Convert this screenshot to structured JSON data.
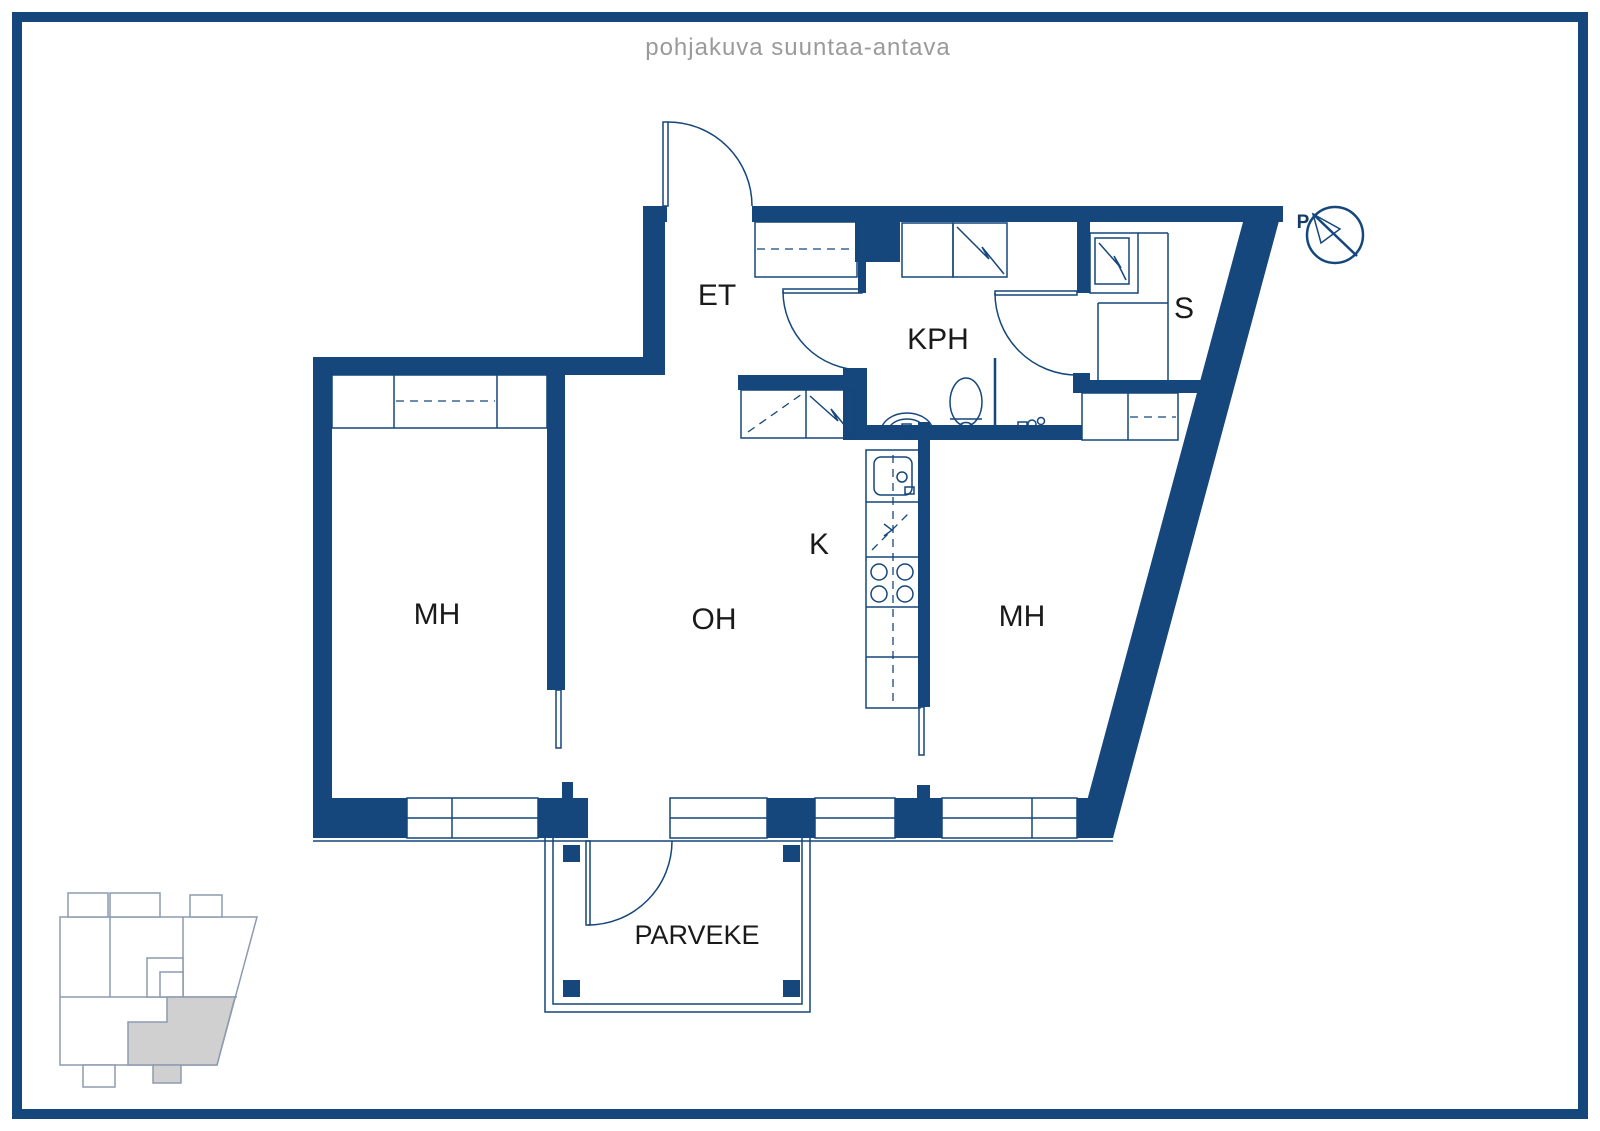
{
  "title": "pohjakuva suuntaa-antava",
  "compass": {
    "label": "P"
  },
  "rooms": {
    "et": {
      "label": "ET"
    },
    "kph": {
      "label": "KPH"
    },
    "sauna": {
      "label": "S"
    },
    "mh_left": {
      "label": "MH"
    },
    "oh": {
      "label": "OH"
    },
    "kitchen": {
      "label": "K"
    },
    "mh_right": {
      "label": "MH"
    },
    "parveke": {
      "label": "PARVEKE"
    }
  },
  "colors": {
    "wall": "#15477C",
    "title_text": "#9A9A9A",
    "label_text": "#1A1A1A",
    "locator_outline": "#8C9BB0",
    "locator_highlight": "#D0D0D0",
    "background": "#FFFFFF"
  }
}
